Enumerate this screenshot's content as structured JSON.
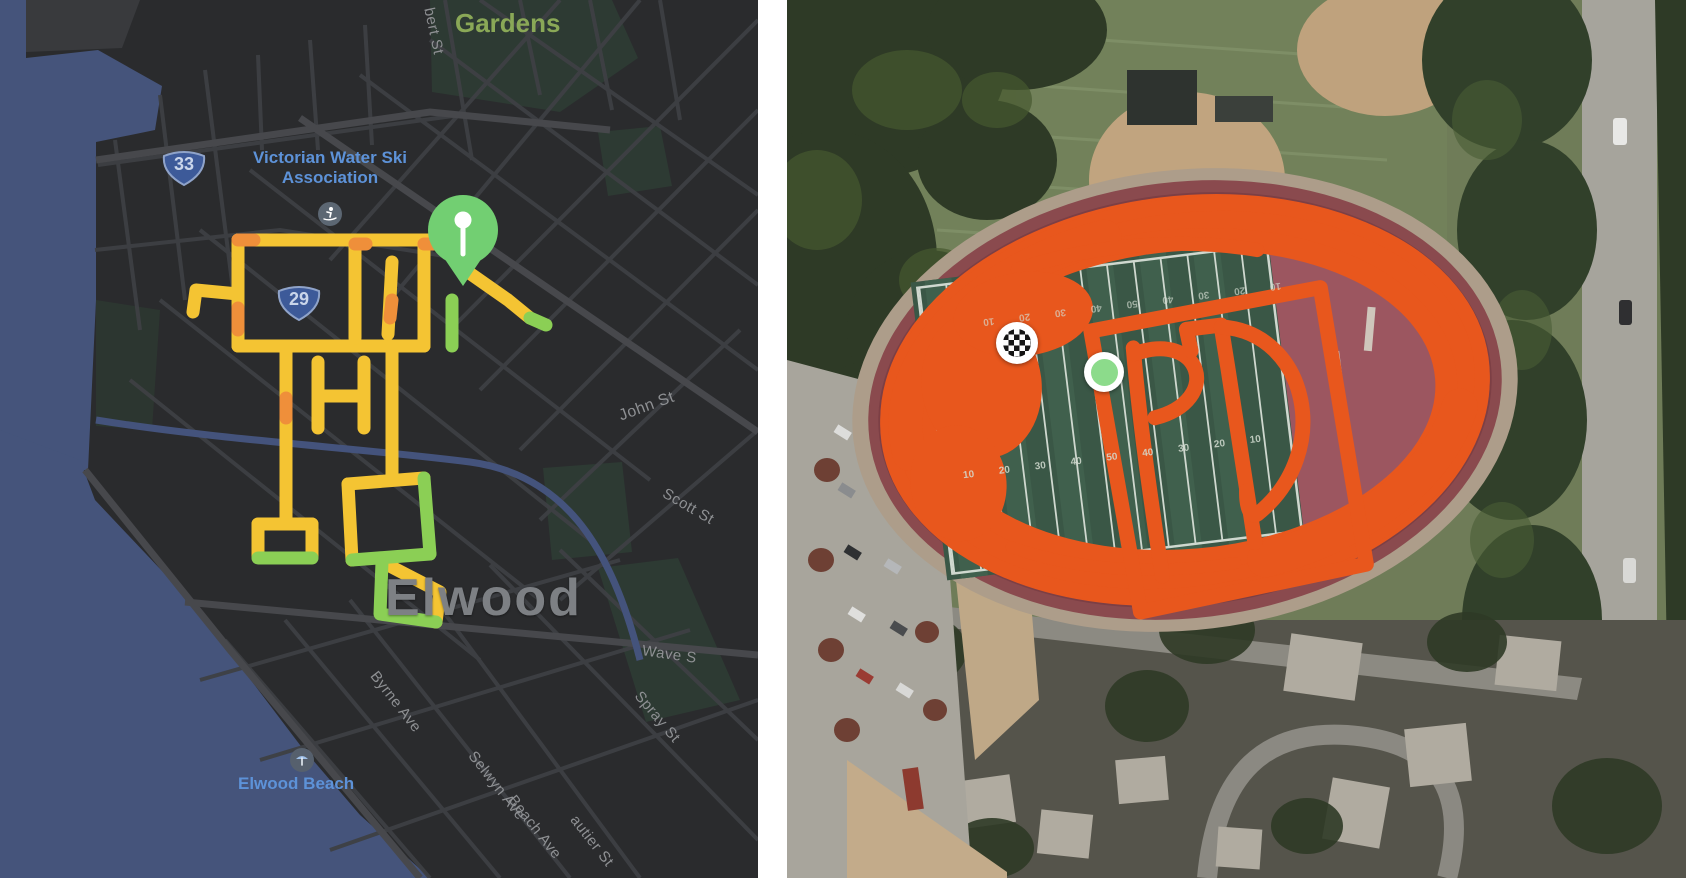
{
  "left_map": {
    "city_label": "Elwood",
    "park_label": "Gardens",
    "poi": {
      "water_ski": "Victorian Water Ski Association",
      "beach": "Elwood Beach"
    },
    "route_shields": {
      "route_33": "33",
      "route_29": "29"
    },
    "street_labels": {
      "cut_top": "bert St",
      "john": "John St",
      "scott": "Scott St",
      "wave": "Wave S",
      "spray": "Spray St",
      "byrne": "Byrne Ave",
      "selwyn": "Selwyn Ave",
      "beach_ave": "Beach Ave",
      "gautier": "autier St"
    },
    "markers": {
      "start_pin": "green pushpin marker"
    },
    "colors": {
      "background": "#2a2b2d",
      "water": "#45547b",
      "park": "#2d3a33",
      "route_yellow": "#f4c433",
      "route_green": "#8bcf55",
      "route_orange": "#ef8f3a",
      "pin_green": "#72cf72",
      "poi_blue": "#5d92d8",
      "label_gray": "#8e9093"
    }
  },
  "right_map": {
    "route_text": "PD",
    "markers": {
      "finish": "checkered finish marker",
      "start": "green start dot"
    },
    "yard_numbers": [
      "10",
      "20",
      "30",
      "40",
      "50",
      "40",
      "30",
      "20",
      "10"
    ],
    "colors": {
      "route_orange": "#e8571d",
      "track_red": "#7c3f45",
      "dzone_red": "#9c5660",
      "field_green": "#3a5746",
      "start_dot_green": "#8cdb8b"
    }
  }
}
